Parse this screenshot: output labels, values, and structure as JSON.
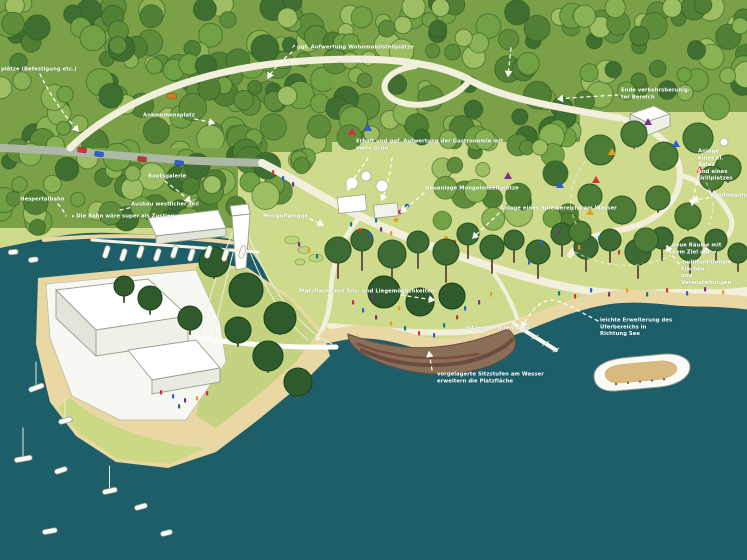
{
  "scene_title": "Lageplan-Illustration Seeufer",
  "annotations": [
    {
      "id": "stellplaetze",
      "text": "plätze (Befestigung etc.)"
    },
    {
      "id": "wohnmobil",
      "icon": "arrow-up-right",
      "text": "ggf. Aufwertung Wohnmobilstellplätze"
    },
    {
      "id": "ankommensplatz",
      "text": "Ankommensplatz"
    },
    {
      "id": "hespertalbahn",
      "text": "Hespertalbahn"
    },
    {
      "id": "bahn-zustieg",
      "icon": "triangle-right",
      "text": "Die Bahn wäre super als Zustieg"
    },
    {
      "id": "bootsgalerie",
      "text": "Bootsgalerie"
    },
    {
      "id": "westlicher-teil",
      "text": "Ausbau westlicher Teil"
    },
    {
      "id": "minigolf",
      "text": "Minigolfanlage"
    },
    {
      "id": "gastronomie",
      "text": "Erhalt und ggf. Aufwertung der Gastronomie mit\nmehr Grün"
    },
    {
      "id": "mongolenzelte",
      "text": "Neuanlage Mongolenzeltplätze"
    },
    {
      "id": "spielbereich",
      "text": "Anlage eines Spielbereichs am Wasser"
    },
    {
      "id": "verkehrsberuhigt",
      "text": "Ende verkehrsberuhig-\nter Bereich"
    },
    {
      "id": "cafe-grill",
      "text": "Anlage eines kl. Cafés\nund eines Grillplatzes"
    },
    {
      "id": "rundweg",
      "text": "Rundwegangebot"
    },
    {
      "id": "neue-raeume",
      "icon_after": "arrow-right",
      "text": "neue Räume mit dem Ziel auf"
    },
    {
      "id": "multifunktional",
      "text": "multifunktionale Flächen\nund Veranstaltungen"
    },
    {
      "id": "ufererweiterung",
      "text": "leichte Erweiterung des Uferbereichs in\nRichtung See"
    },
    {
      "id": "platzflaeche",
      "text": "Platzfläche mit Sitz- und Liegemöglichkeiten"
    },
    {
      "id": "altes-gleis",
      "text": "Sitzen am alten Gleis"
    },
    {
      "id": "sitzstufen",
      "text": "vorgelagerte Sitzstufen am Wasser\nerweitern die Platzfläche"
    }
  ],
  "icons": {
    "arrow-up-right": "↗",
    "triangle-right": "▸",
    "arrow-right": "➔"
  },
  "palette": {
    "water": "#1E5E68",
    "lawn": "#CEDA8C",
    "forest_base": "#7AA148",
    "forest_greens": [
      "#5F8D3B",
      "#72A045",
      "#89B254",
      "#9DBE62",
      "#517F33",
      "#3F6E31"
    ],
    "tree_dark": "#3E6B33",
    "tree_darker": "#2F5A2C",
    "path_cream": "#F2EFDC",
    "road_grey": "#ADB8A6",
    "sand": "#E9D7A4",
    "brown_steps": "#8A6F58",
    "brown_dark": "#6D4C3F",
    "brown_red": "#7E4A3E",
    "building_white": "#FFFFFF",
    "building_side": "#E2E5DA",
    "ship_deck": "#D9B97F",
    "label_text": "#FFFFFF",
    "accent_red": "#D6303E",
    "accent_blue": "#2B5FD9",
    "accent_purple": "#7B2D8B",
    "accent_yellow": "#E8A020",
    "accent_orange": "#E07820"
  }
}
